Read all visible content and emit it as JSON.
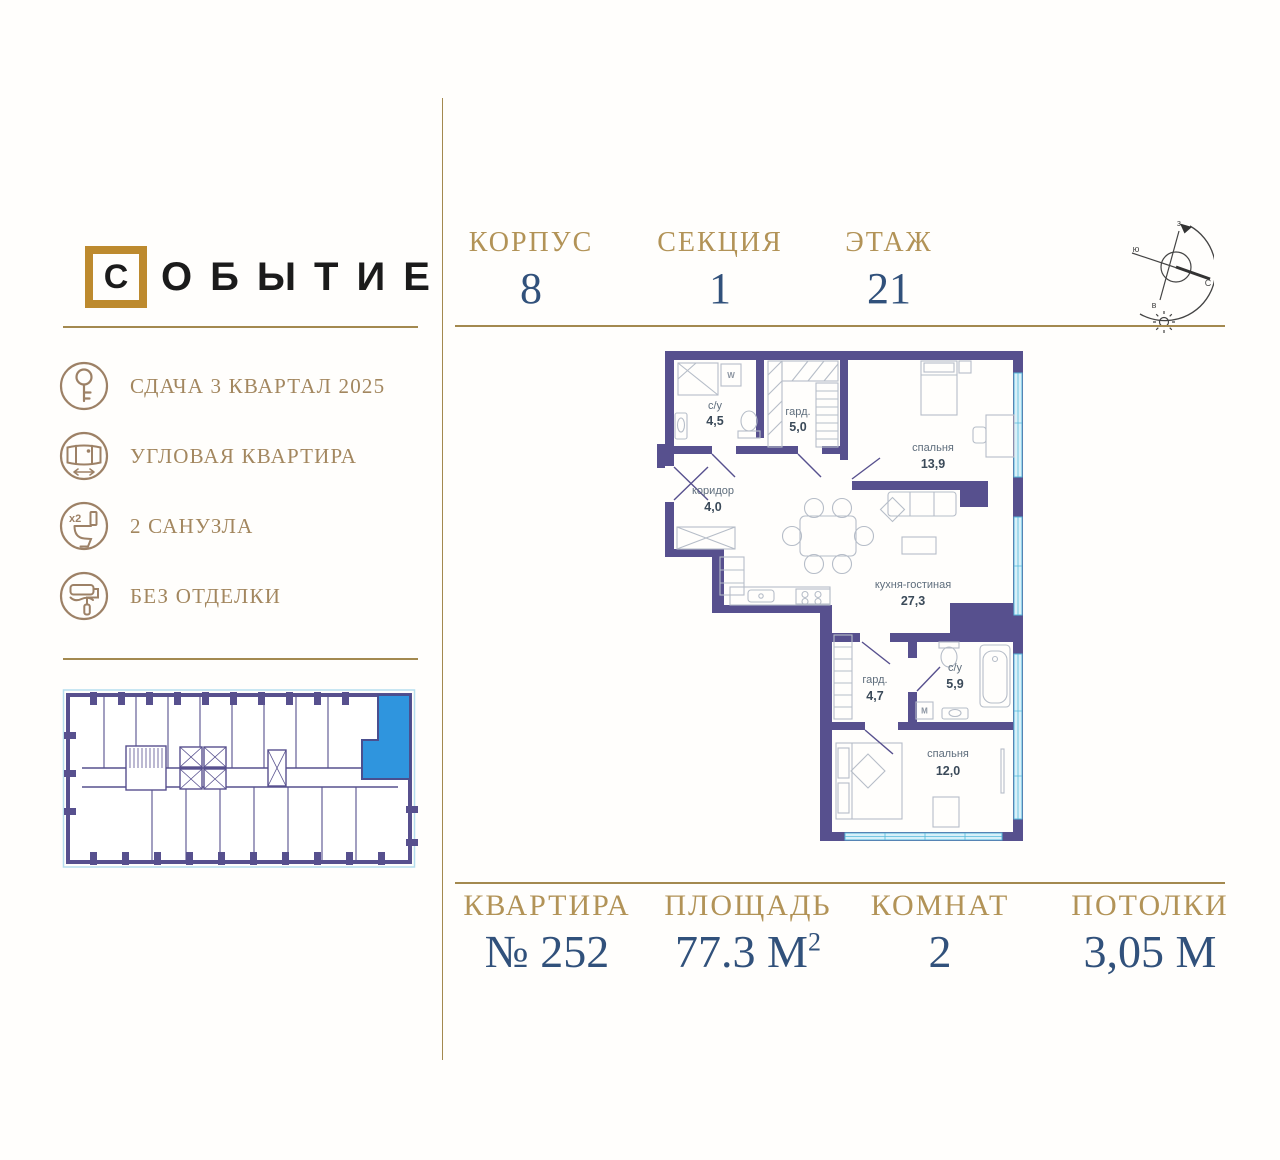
{
  "logo": {
    "first_letter": "С",
    "rest": "ОБЫТИЕ",
    "full": "СОБЫТИЕ"
  },
  "colors": {
    "gold_line": "#a3894f",
    "gold_label": "#b29357",
    "navy_value": "#31517b",
    "bronze_icon": "#9d8166",
    "wall": "#57508e",
    "window": "#d9f0f9",
    "highlight_blue": "#2f95de",
    "logo_box": "#bd8a2e"
  },
  "building": {
    "stats": [
      {
        "label": "КОРПУС",
        "value": "8"
      },
      {
        "label": "СЕКЦИЯ",
        "value": "1"
      },
      {
        "label": "ЭТАЖ",
        "value": "21"
      }
    ]
  },
  "features": [
    {
      "icon": "key-icon",
      "label": "СДАЧА 3 КВАРТАЛ 2025"
    },
    {
      "icon": "panorama-window-icon",
      "label": "УГЛОВАЯ КВАРТИРА"
    },
    {
      "icon": "toilet-x2-icon",
      "label": "2 САНУЗЛА",
      "badge": "x2"
    },
    {
      "icon": "paint-roller-icon",
      "label": "БЕЗ ОТДЕЛКИ"
    }
  ],
  "compass": {
    "north": "С",
    "south": "ю",
    "west": "з",
    "east": "в"
  },
  "floor_plan": {
    "rooms": [
      {
        "name": "с/у",
        "area": "4,5"
      },
      {
        "name": "гард.",
        "area": "5,0"
      },
      {
        "name": "спальня",
        "area": "13,9"
      },
      {
        "name": "коридор",
        "area": "4,0"
      },
      {
        "name": "кухня-гостиная",
        "area": "27,3"
      },
      {
        "name": "гард.",
        "area": "4,7"
      },
      {
        "name": "с/у",
        "area": "5,9"
      },
      {
        "name": "спальня",
        "area": "12,0"
      }
    ],
    "appliances": {
      "washer_top": "W",
      "washer_bottom": "M"
    }
  },
  "apartment": {
    "stats": [
      {
        "label": "КВАРТИРА",
        "value": "№ 252"
      },
      {
        "label": "ПЛОЩАДЬ",
        "value": "77.3 М",
        "sup": "2"
      },
      {
        "label": "КОМНАТ",
        "value": "2"
      },
      {
        "label": "ПОТОЛКИ",
        "value": "3,05 М"
      }
    ]
  }
}
